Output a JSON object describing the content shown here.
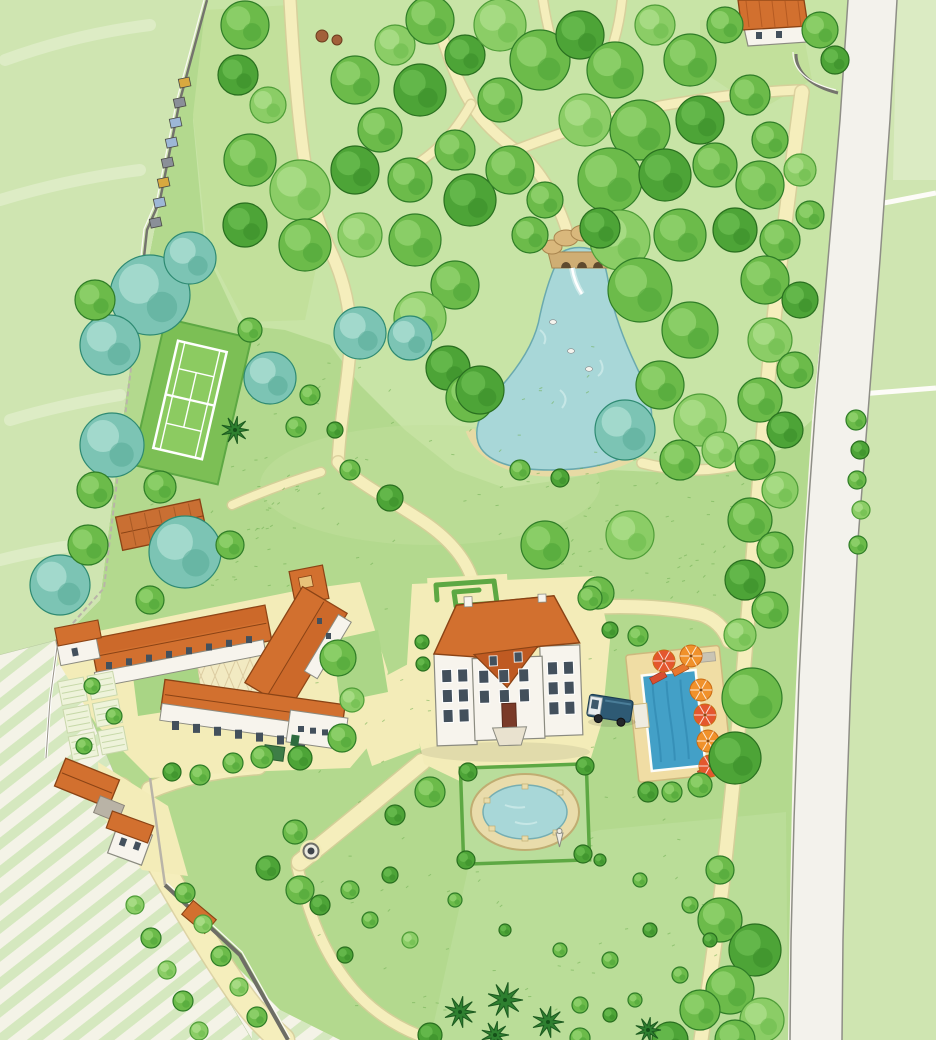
{
  "map": {
    "features": [
      {
        "name": "meadow-west"
      },
      {
        "name": "meadow-east"
      },
      {
        "name": "country-road"
      },
      {
        "name": "boundary-wall"
      },
      {
        "name": "beehives"
      },
      {
        "name": "haystacks"
      },
      {
        "name": "woodland-park"
      },
      {
        "name": "woodland-paths"
      },
      {
        "name": "garden-pond"
      },
      {
        "name": "grotto-bridge"
      },
      {
        "name": "ducks"
      },
      {
        "name": "tennis-court"
      },
      {
        "name": "open-barn"
      },
      {
        "name": "farm-courtyard"
      },
      {
        "name": "vegetable-garden"
      },
      {
        "name": "chateau"
      },
      {
        "name": "labyrinth-hedge"
      },
      {
        "name": "forecourt"
      },
      {
        "name": "swimming-pool"
      },
      {
        "name": "pool-umbrellas"
      },
      {
        "name": "sun-loungers"
      },
      {
        "name": "camper-van"
      },
      {
        "name": "ornamental-basin"
      },
      {
        "name": "fountain-statue"
      },
      {
        "name": "well"
      },
      {
        "name": "gate-lodge"
      },
      {
        "name": "vineyard"
      },
      {
        "name": "tree-lined-driveway"
      },
      {
        "name": "palm-trees"
      },
      {
        "name": "roadside-cottage"
      },
      {
        "name": "perimeter-path"
      },
      {
        "name": "great-lawn"
      }
    ],
    "palette": {
      "paper": "#f7f5ec",
      "meadow": "#cfe5b1",
      "meadowLight": "#e0eecb",
      "lawn": "#b3d98e",
      "lawnTop": "#c2e09b",
      "wood": "#c8e4a6",
      "lawnSoft": "#bfe0a0",
      "path": "#f5eebc",
      "pathEdge": "#d8cc9a",
      "sand": "#f3ecb8",
      "road": "#f3f2ec",
      "roadEdge": "#8e8e86",
      "wall": "#74746d",
      "water": "#a8d7d8",
      "waterEdge": "#6aa9ae",
      "shore": "#ead9a4",
      "pool": "#43a0c7",
      "poolDark": "#2f86ad",
      "roof": "#d2702f",
      "roofDark": "#bf5a22",
      "ridge": "#8a4315",
      "white": "#f7f4ed",
      "bstroke": "#8b8b80",
      "window": "#43505c",
      "hedge": "#5da843",
      "fleck": "#6fae52",
      "treeG": "#6cbb4a",
      "treeGs": "#2f7d27",
      "treeGh": "#8ed06a",
      "treeL": "#8bcd66",
      "treeLs": "#4f9d38",
      "treeLh": "#a9dd86",
      "treeD": "#4da437",
      "treeDs": "#296f1f",
      "treeDh": "#66b94d",
      "treeT": "#7cc4b4",
      "treeTs": "#2e8a72",
      "treeTh": "#a6dcce",
      "palm": "#2e8030",
      "palmStroke": "#1c5a1f",
      "vine": "#d5e8bf",
      "vineBase": "#f4f3e7",
      "hiveYellow": "#d8a93f",
      "hiveGray": "#8a8f98",
      "hiveBlue": "#9db7d6",
      "umbrella": "#f0912b",
      "umbrella2": "#e4572e",
      "umbrellaDk": "#c96a14",
      "lounger1": "#d84e31",
      "lounger2": "#e8772f",
      "van": "#2e5a74",
      "vanCab": "#e8ecee",
      "stone": "#d9b87c",
      "stoneDk": "#a9854e",
      "tank": "#3e7d46",
      "hay": "#a2603a",
      "hayDk": "#6b3c1e"
    }
  }
}
